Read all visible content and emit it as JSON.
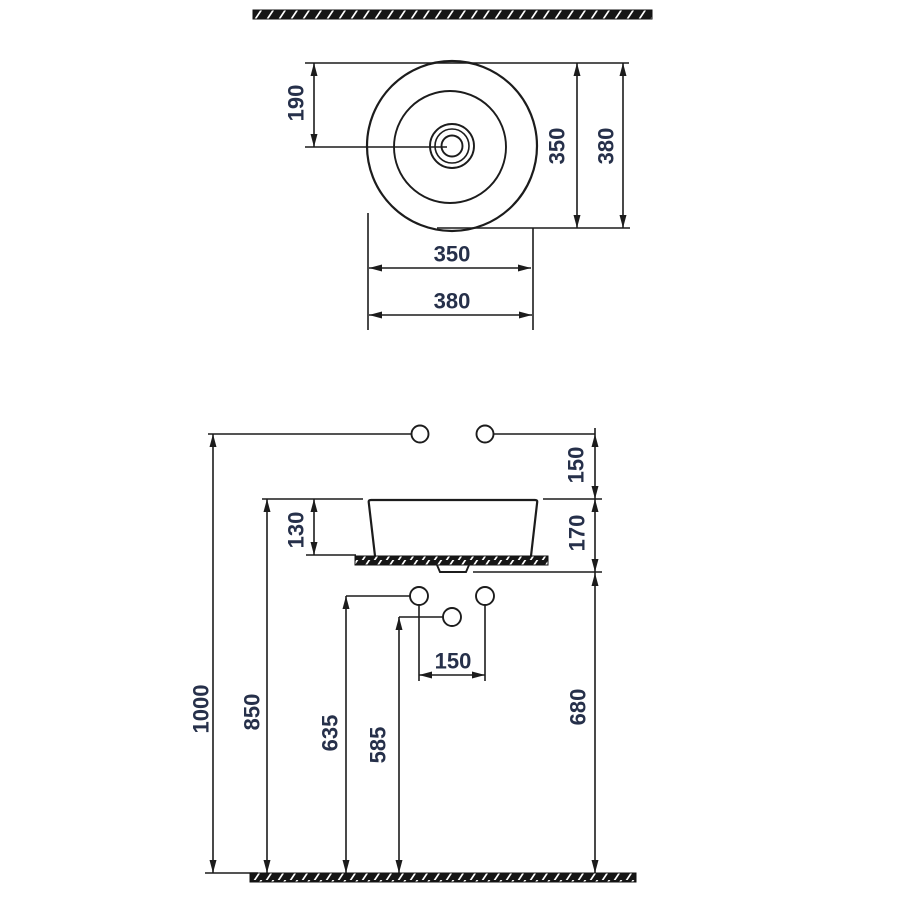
{
  "drawing": {
    "type": "washbasin-technical-drawing",
    "background_color": "#ffffff",
    "line_color": "#1c1c1c",
    "dimension_text_color": "#26304a",
    "top_view": {
      "dim_center_offset": "190",
      "dim_inner_vertical": "350",
      "dim_overall_vertical": "380",
      "dim_inner_horizontal": "350",
      "dim_overall_horizontal": "380"
    },
    "front_view": {
      "dim_supply_to_rim": "150",
      "dim_basin_height": "130",
      "dim_rim_to_drain_level": "170",
      "dim_outlet_spacing": "150",
      "dim_supply_height": "1000",
      "dim_rim_height": "850",
      "dim_outlet_height_left": "635",
      "dim_outlet_height_center": "585",
      "dim_drain_height": "680"
    }
  }
}
